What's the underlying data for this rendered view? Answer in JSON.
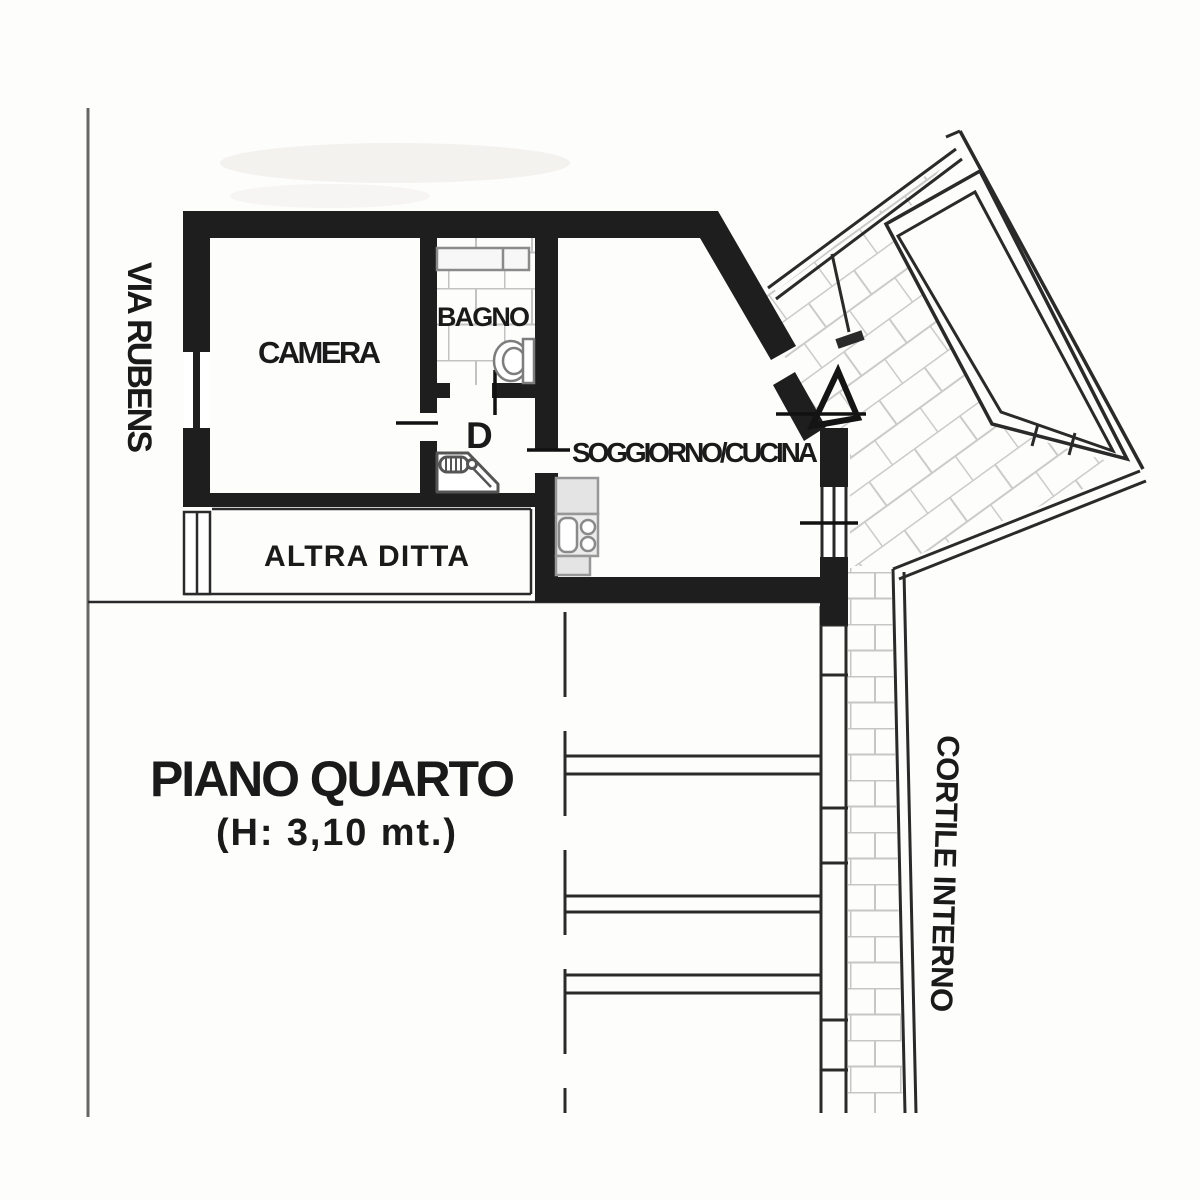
{
  "plan": {
    "title": "PIANO QUARTO",
    "subtitle": "(H: 3,10 mt.)",
    "street": "VIA RUBENS",
    "courtyard": "CORTILE INTERNO",
    "rooms": {
      "camera": "CAMERA",
      "bagno": "BAGNO",
      "disimpegno": "D",
      "soggiorno_cucina": "SOGGIORNO/CUCINA",
      "altra_ditta": "ALTRA DITTA"
    },
    "icons": {
      "bathroom_sink": "sink-counter-icon",
      "toilet": "toilet-icon",
      "water_heater": "water-heater-icon",
      "kitchen_unit": "kitchen-unit-icon",
      "door_swing": "door-swing-icon",
      "terrace_hatch": "terrace-tile-hatch",
      "brick_hatch": "courtyard-brick-hatch",
      "window": "window-symbol"
    },
    "colors": {
      "wall": "#1e1e1e",
      "thin_line": "#2a2a2a",
      "street_line": "#666666",
      "tile_line": "#c6c6c6",
      "fixture_stroke": "#8a8a8a",
      "fixture_fill": "#e4e4e4",
      "background": "#fdfdfc",
      "text": "#1a1a1a"
    }
  }
}
